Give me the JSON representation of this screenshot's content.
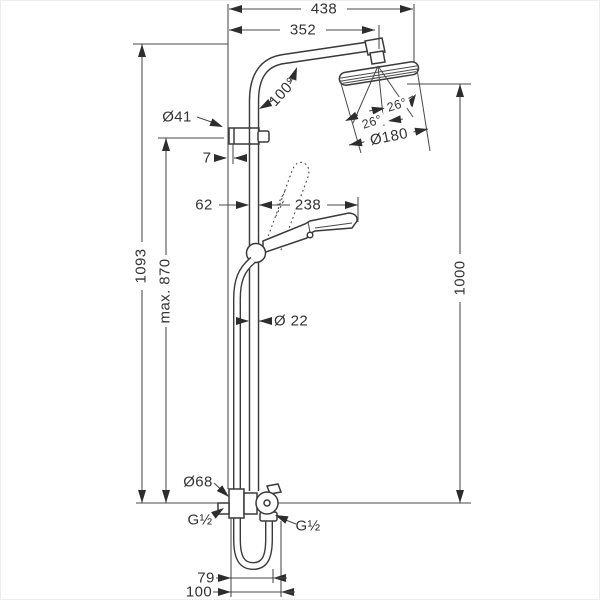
{
  "annotations": {
    "width_total": "438",
    "width_arm": "352",
    "arm_angle": "100°",
    "bracket_diameter": "Ø41",
    "bracket_gap": "7",
    "rail_offset": "62",
    "handshower_length": "238",
    "spray_angle_right": "26°",
    "spray_angle_left": "26°",
    "head_diameter": "Ø180",
    "height_total": "1093",
    "height_max": "max. 870",
    "height_rail": "1000",
    "rail_diameter": "Ø 22",
    "escutcheon_diameter": "Ø68",
    "thread_inlet": "G½",
    "thread_outlet": "G½",
    "bottom_offset_hose": "79",
    "bottom_offset_outlet": "100"
  },
  "colors": {
    "line": "#3a3a3a",
    "dimension": "#4a4a4a",
    "background": "#ffffff"
  }
}
